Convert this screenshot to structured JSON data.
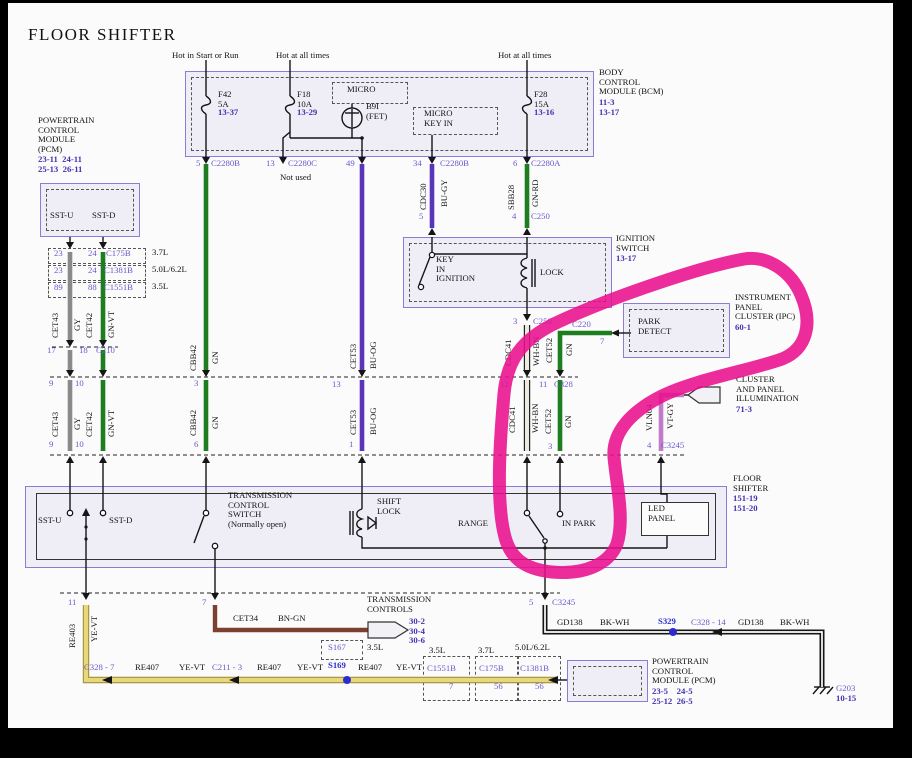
{
  "title": "FLOOR SHIFTER",
  "colors": {
    "module_fill": "#efeef6",
    "module_border": "#8c7cd2",
    "purple_text": "#6b59c9",
    "ref_text": "#4232ae",
    "splice_blue": "#2b2bcf",
    "wire_gray": "#8a8a8a",
    "wire_green": "#1e7d1e",
    "wire_violet": "#5a35b8",
    "wire_white": "#eceade",
    "wire_vtgy": "#c07cc8",
    "wire_yellow": "#e9d87a",
    "wire_yellow_edge": "#a08f3c",
    "wire_brown": "#7b4030",
    "wire_black": "#151515",
    "annotation_pink": "#ea0f8e"
  },
  "annotation": {
    "type": "hand-drawn marker circle",
    "color": "#ea0f8e",
    "encircles": "PARK DETECT (IPC) and RANGE / IN PARK shifter circuit"
  },
  "labels": [
    {
      "n": "page-title",
      "t": "FLOOR SHIFTER",
      "x": 28,
      "y": 30,
      "c": "t"
    },
    {
      "n": "hot-start-run",
      "t": "Hot in Start or Run",
      "x": 172,
      "y": 51
    },
    {
      "n": "hot-all-times-1",
      "t": "Hot at all times",
      "x": 276,
      "y": 51
    },
    {
      "n": "hot-all-times-2",
      "t": "Hot at all times",
      "x": 498,
      "y": 51
    },
    {
      "n": "fuse-f42",
      "t": "F42\n5A",
      "x": 218,
      "y": 90
    },
    {
      "n": "fuse-f42-ref",
      "t": "13-37",
      "x": 218,
      "y": 108,
      "c": "rf"
    },
    {
      "n": "fuse-f18",
      "t": "F18\n10A",
      "x": 297,
      "y": 90
    },
    {
      "n": "fuse-f18-ref",
      "t": "13-29",
      "x": 297,
      "y": 108,
      "c": "rf"
    },
    {
      "n": "fuse-f28",
      "t": "F28\n15A",
      "x": 534,
      "y": 90
    },
    {
      "n": "fuse-f28-ref",
      "t": "13-16",
      "x": 534,
      "y": 108,
      "c": "rf"
    },
    {
      "n": "micro-label",
      "t": "MICRO",
      "x": 347,
      "y": 85
    },
    {
      "n": "b9i-fet-label",
      "t": "B9I\n(FET)",
      "x": 366,
      "y": 102
    },
    {
      "n": "micro-key-in-label",
      "t": "MICRO\nKEY IN",
      "x": 424,
      "y": 109
    },
    {
      "n": "bcm-name",
      "t": "BODY\nCONTROL\nMODULE (BCM)",
      "x": 599,
      "y": 68
    },
    {
      "n": "bcm-refs",
      "t": "11-3\n13-17",
      "x": 599,
      "y": 98,
      "c": "rf"
    },
    {
      "n": "pin-5-c2280b",
      "t": "5",
      "x": 196,
      "y": 159,
      "c": "pp"
    },
    {
      "n": "conn-c2280b-1",
      "t": "C2280B",
      "x": 211,
      "y": 159,
      "c": "pp"
    },
    {
      "n": "pin-13-c2280c",
      "t": "13",
      "x": 266,
      "y": 159,
      "c": "pp"
    },
    {
      "n": "conn-c2280c",
      "t": "C2280C",
      "x": 288,
      "y": 159,
      "c": "pp"
    },
    {
      "n": "not-used",
      "t": "Not used",
      "x": 280,
      "y": 173
    },
    {
      "n": "pin-49",
      "t": "49",
      "x": 346,
      "y": 159,
      "c": "pp"
    },
    {
      "n": "pin-34",
      "t": "34",
      "x": 413,
      "y": 159,
      "c": "pp"
    },
    {
      "n": "conn-c2280b-2",
      "t": "C2280B",
      "x": 440,
      "y": 159,
      "c": "pp"
    },
    {
      "n": "pin-6-c2280a",
      "t": "6",
      "x": 513,
      "y": 159,
      "c": "pp"
    },
    {
      "n": "conn-c2280a",
      "t": "C2280A",
      "x": 531,
      "y": 159,
      "c": "pp"
    },
    {
      "n": "pcm-top-name",
      "t": "POWERTRAIN\nCONTROL\nMODULE\n(PCM)",
      "x": 38,
      "y": 116
    },
    {
      "n": "pcm-top-refs",
      "t": "23-11  24-11\n25-13  26-11",
      "x": 38,
      "y": 155,
      "c": "rf"
    },
    {
      "n": "pcm-sst-u",
      "t": "SST-U",
      "x": 50,
      "y": 211
    },
    {
      "n": "pcm-sst-d",
      "t": "SST-D",
      "x": 92,
      "y": 211
    },
    {
      "n": "pin-a-23",
      "t": "23",
      "x": 54,
      "y": 249,
      "c": "pp"
    },
    {
      "n": "pin-a-24",
      "t": "24",
      "x": 88,
      "y": 249,
      "c": "pp"
    },
    {
      "n": "conn-c175b",
      "t": "C175B",
      "x": 106,
      "y": 249,
      "c": "pp"
    },
    {
      "n": "eng-37l-a",
      "t": "3.7L",
      "x": 152,
      "y": 248
    },
    {
      "n": "pin-b-23",
      "t": "23",
      "x": 54,
      "y": 266,
      "c": "pp"
    },
    {
      "n": "pin-b-24",
      "t": "24",
      "x": 88,
      "y": 266,
      "c": "pp"
    },
    {
      "n": "conn-c1381b-1",
      "t": "C1381B",
      "x": 104,
      "y": 266,
      "c": "pp"
    },
    {
      "n": "eng-50l-a",
      "t": "5.0L/6.2L",
      "x": 152,
      "y": 265
    },
    {
      "n": "pin-c-89",
      "t": "89",
      "x": 54,
      "y": 283,
      "c": "pp"
    },
    {
      "n": "pin-c-88",
      "t": "88",
      "x": 88,
      "y": 283,
      "c": "pp"
    },
    {
      "n": "conn-c1551b-1",
      "t": "C1551B",
      "x": 104,
      "y": 283,
      "c": "pp"
    },
    {
      "n": "eng-35l-a",
      "t": "3.5L",
      "x": 152,
      "y": 282
    },
    {
      "n": "wire-cet43-u",
      "t": "CET43",
      "x": 51,
      "y": 338,
      "c": "vt"
    },
    {
      "n": "wire-gy-u",
      "t": "GY",
      "x": 73,
      "y": 331,
      "c": "vt"
    },
    {
      "n": "wire-cet42-u",
      "t": "CET42",
      "x": 85,
      "y": 338,
      "c": "vt"
    },
    {
      "n": "wire-gnvt-u",
      "t": "GN-VT",
      "x": 107,
      "y": 338,
      "c": "vt"
    },
    {
      "n": "wire-cbb42-u",
      "t": "CBB42",
      "x": 189,
      "y": 371,
      "c": "vt"
    },
    {
      "n": "wire-gn-u1",
      "t": "GN",
      "x": 211,
      "y": 364,
      "c": "vt"
    },
    {
      "n": "wire-cet53-u",
      "t": "CET53",
      "x": 349,
      "y": 369,
      "c": "vt"
    },
    {
      "n": "wire-buog-u",
      "t": "BU-OG",
      "x": 369,
      "y": 369,
      "c": "vt"
    },
    {
      "n": "wire-cdc30",
      "t": "CDC30",
      "x": 419,
      "y": 210,
      "c": "vt"
    },
    {
      "n": "wire-bugy",
      "t": "BU-GY",
      "x": 440,
      "y": 207,
      "c": "vt"
    },
    {
      "n": "wire-sbb28",
      "t": "SBB28",
      "x": 507,
      "y": 210,
      "c": "vt"
    },
    {
      "n": "wire-gnrd",
      "t": "GN-RD",
      "x": 531,
      "y": 207,
      "c": "vt"
    },
    {
      "n": "pin-17",
      "t": "17",
      "x": 47,
      "y": 346,
      "c": "pp"
    },
    {
      "n": "pin-18",
      "t": "18",
      "x": 79,
      "y": 346,
      "c": "pp"
    },
    {
      "n": "conn-c210",
      "t": "C210",
      "x": 96,
      "y": 346,
      "c": "pp"
    },
    {
      "n": "pin-5-c250",
      "t": "5",
      "x": 419,
      "y": 212,
      "c": "pp"
    },
    {
      "n": "pin-4-c250",
      "t": "4",
      "x": 512,
      "y": 212,
      "c": "pp"
    },
    {
      "n": "conn-c250-top",
      "t": "C250",
      "x": 531,
      "y": 212,
      "c": "pp"
    },
    {
      "n": "ign-name",
      "t": "IGNITION\nSWITCH",
      "x": 616,
      "y": 234
    },
    {
      "n": "ign-ref",
      "t": "13-17",
      "x": 616,
      "y": 254,
      "c": "rf"
    },
    {
      "n": "key-in-ignition",
      "t": "KEY\nIN\nIGNITION",
      "x": 436,
      "y": 255
    },
    {
      "n": "lock-label",
      "t": "LOCK",
      "x": 540,
      "y": 268
    },
    {
      "n": "pin-3-c250",
      "t": "3",
      "x": 513,
      "y": 317,
      "c": "pp"
    },
    {
      "n": "conn-c250-bot",
      "t": "C250",
      "x": 533,
      "y": 317,
      "c": "pp"
    },
    {
      "n": "conn-c220",
      "t": "C220",
      "x": 572,
      "y": 320,
      "c": "pp"
    },
    {
      "n": "pin-7-c220",
      "t": "7",
      "x": 600,
      "y": 337,
      "c": "pp"
    },
    {
      "n": "ipc-name",
      "t": "INSTRUMENT\nPANEL\nCLUSTER (IPC)",
      "x": 735,
      "y": 293
    },
    {
      "n": "ipc-ref",
      "t": "60-1",
      "x": 735,
      "y": 323,
      "c": "rf"
    },
    {
      "n": "park-detect",
      "t": "PARK\nDETECT",
      "x": 638,
      "y": 317
    },
    {
      "n": "wire-cdc41-u",
      "t": "CDC41",
      "x": 504,
      "y": 366,
      "c": "vt"
    },
    {
      "n": "wire-whbn-u",
      "t": "WH-BN",
      "x": 532,
      "y": 366,
      "c": "vt"
    },
    {
      "n": "wire-cet52-u",
      "t": "CET52",
      "x": 545,
      "y": 363,
      "c": "vt"
    },
    {
      "n": "wire-gn-u2",
      "t": "GN",
      "x": 565,
      "y": 356,
      "c": "vt"
    },
    {
      "n": "pin-9-c328",
      "t": "9",
      "x": 49,
      "y": 379,
      "c": "pp"
    },
    {
      "n": "pin-10-c328",
      "t": "10",
      "x": 75,
      "y": 379,
      "c": "pp"
    },
    {
      "n": "pin-3-c328",
      "t": "3",
      "x": 194,
      "y": 379,
      "c": "pp"
    },
    {
      "n": "pin-13-c328",
      "t": "13",
      "x": 332,
      "y": 380,
      "c": "pp"
    },
    {
      "n": "pin-12-c328",
      "t": "12",
      "x": 500,
      "y": 380,
      "c": "pp"
    },
    {
      "n": "pin-11-c328",
      "t": "11",
      "x": 539,
      "y": 380,
      "c": "pp"
    },
    {
      "n": "conn-c328",
      "t": "C328",
      "x": 554,
      "y": 380,
      "c": "pp"
    },
    {
      "n": "wire-cet43-l",
      "t": "CET43",
      "x": 51,
      "y": 437,
      "c": "vt"
    },
    {
      "n": "wire-gy-l",
      "t": "GY",
      "x": 73,
      "y": 430,
      "c": "vt"
    },
    {
      "n": "wire-cet42-l",
      "t": "CET42",
      "x": 85,
      "y": 437,
      "c": "vt"
    },
    {
      "n": "wire-gnvt-l",
      "t": "GN-VT",
      "x": 107,
      "y": 437,
      "c": "vt"
    },
    {
      "n": "wire-cbb42-l",
      "t": "CBB42",
      "x": 189,
      "y": 436,
      "c": "vt"
    },
    {
      "n": "wire-gn-l1",
      "t": "GN",
      "x": 211,
      "y": 429,
      "c": "vt"
    },
    {
      "n": "wire-cet53-l",
      "t": "CET53",
      "x": 349,
      "y": 435,
      "c": "vt"
    },
    {
      "n": "wire-buog-l",
      "t": "BU-OG",
      "x": 369,
      "y": 435,
      "c": "vt"
    },
    {
      "n": "wire-cdc41-l",
      "t": "CDC41",
      "x": 508,
      "y": 433,
      "c": "vt"
    },
    {
      "n": "wire-whbn-l",
      "t": "WH-BN",
      "x": 531,
      "y": 433,
      "c": "vt"
    },
    {
      "n": "wire-cet52-l",
      "t": "CET52",
      "x": 544,
      "y": 434,
      "c": "vt"
    },
    {
      "n": "wire-gn-l2",
      "t": "GN",
      "x": 564,
      "y": 428,
      "c": "vt"
    },
    {
      "n": "wire-vln04",
      "t": "VLN04",
      "x": 645,
      "y": 431,
      "c": "vt"
    },
    {
      "n": "wire-vtgy",
      "t": "VT-GY",
      "x": 666,
      "y": 429,
      "c": "vt"
    },
    {
      "n": "illum-name",
      "t": "CLUSTER\nAND PANEL\nILLUMINATION",
      "x": 736,
      "y": 375
    },
    {
      "n": "illum-ref",
      "t": "71-3",
      "x": 736,
      "y": 405,
      "c": "rf"
    },
    {
      "n": "pin-9-c3245",
      "t": "9",
      "x": 49,
      "y": 440,
      "c": "pp"
    },
    {
      "n": "pin-10-c3245",
      "t": "10",
      "x": 75,
      "y": 440,
      "c": "pp"
    },
    {
      "n": "pin-6-c3245",
      "t": "6",
      "x": 194,
      "y": 440,
      "c": "pp"
    },
    {
      "n": "pin-1-c3245",
      "t": "1",
      "x": 349,
      "y": 440,
      "c": "pp"
    },
    {
      "n": "pin-3-c3245",
      "t": "3",
      "x": 548,
      "y": 442,
      "c": "pp"
    },
    {
      "n": "pin-4-c3245",
      "t": "4",
      "x": 647,
      "y": 441,
      "c": "pp"
    },
    {
      "n": "conn-c3245-top",
      "t": "C3245",
      "x": 661,
      "y": 441,
      "c": "pp"
    },
    {
      "n": "fs-name",
      "t": "FLOOR\nSHIFTER",
      "x": 733,
      "y": 474
    },
    {
      "n": "fs-refs",
      "t": "151-19\n151-20",
      "x": 733,
      "y": 494,
      "c": "rf"
    },
    {
      "n": "shifter-sst-u",
      "t": "SST-U",
      "x": 38,
      "y": 516
    },
    {
      "n": "shifter-sst-d",
      "t": "SST-D",
      "x": 109,
      "y": 516
    },
    {
      "n": "tcs-label",
      "t": "TRANSMISSION\nCONTROL\nSWITCH\n(Normally open)",
      "x": 228,
      "y": 491
    },
    {
      "n": "shift-lock-label",
      "t": "SHIFT\nLOCK",
      "x": 377,
      "y": 497
    },
    {
      "n": "range-label",
      "t": "RANGE",
      "x": 458,
      "y": 519
    },
    {
      "n": "in-park-label",
      "t": "IN PARK",
      "x": 562,
      "y": 519
    },
    {
      "n": "led-panel-label",
      "t": "LED\nPANEL",
      "x": 648,
      "y": 504
    },
    {
      "n": "pin-11-bot",
      "t": "11",
      "x": 68,
      "y": 598,
      "c": "pp"
    },
    {
      "n": "pin-7-bot",
      "t": "7",
      "x": 202,
      "y": 598,
      "c": "pp"
    },
    {
      "n": "pin-5-bot",
      "t": "5",
      "x": 529,
      "y": 598,
      "c": "pp"
    },
    {
      "n": "conn-c3245-bot",
      "t": "C3245",
      "x": 552,
      "y": 598,
      "c": "pp"
    },
    {
      "n": "wire-re403",
      "t": "RE403",
      "x": 68,
      "y": 648,
      "c": "vt"
    },
    {
      "n": "wire-yevt-0",
      "t": "YE-VT",
      "x": 90,
      "y": 642,
      "c": "vt"
    },
    {
      "n": "wire-cet34",
      "t": "CET34",
      "x": 233,
      "y": 614
    },
    {
      "n": "wire-bngn",
      "t": "BN-GN",
      "x": 278,
      "y": 614
    },
    {
      "n": "tc-name",
      "t": "TRANSMISSION\nCONTROLS",
      "x": 367,
      "y": 595
    },
    {
      "n": "tc-refs",
      "t": "30-2\n30-4\n30-6",
      "x": 409,
      "y": 617,
      "c": "rf"
    },
    {
      "n": "conn-c328-7",
      "t": "C328 - 7",
      "x": 84,
      "y": 663,
      "c": "pp"
    },
    {
      "n": "wire-re407-1",
      "t": "RE407",
      "x": 135,
      "y": 663
    },
    {
      "n": "wire-yevt-1",
      "t": "YE-VT",
      "x": 179,
      "y": 663
    },
    {
      "n": "conn-c211-3",
      "t": "C211 - 3",
      "x": 212,
      "y": 663,
      "c": "pp"
    },
    {
      "n": "wire-re407-2",
      "t": "RE407",
      "x": 257,
      "y": 663
    },
    {
      "n": "wire-yevt-2",
      "t": "YE-VT",
      "x": 297,
      "y": 663
    },
    {
      "n": "splice-s167",
      "t": "S167",
      "x": 328,
      "y": 643,
      "c": "pp"
    },
    {
      "n": "eng-35l-s167",
      "t": "3.5L",
      "x": 367,
      "y": 643
    },
    {
      "n": "splice-s169",
      "t": "S169",
      "x": 328,
      "y": 661,
      "c": "bl"
    },
    {
      "n": "wire-re407-3",
      "t": "RE407",
      "x": 358,
      "y": 663
    },
    {
      "n": "wire-yevt-3",
      "t": "YE-VT",
      "x": 396,
      "y": 663
    },
    {
      "n": "eng-35l-b",
      "t": "3.5L",
      "x": 429,
      "y": 646
    },
    {
      "n": "conn-c1551b-2",
      "t": "C1551B",
      "x": 427,
      "y": 664,
      "c": "pp"
    },
    {
      "n": "pin-7-c1551b",
      "t": "7",
      "x": 449,
      "y": 682,
      "c": "pp"
    },
    {
      "n": "eng-37l-b",
      "t": "3.7L",
      "x": 478,
      "y": 646
    },
    {
      "n": "conn-c175b-2",
      "t": "C175B",
      "x": 479,
      "y": 664,
      "c": "pp"
    },
    {
      "n": "pin-56-c175b",
      "t": "56",
      "x": 494,
      "y": 682,
      "c": "pp"
    },
    {
      "n": "eng-50l-b",
      "t": "5.0L/6.2L",
      "x": 515,
      "y": 643
    },
    {
      "n": "conn-c1381b-2",
      "t": "C1381B",
      "x": 520,
      "y": 664,
      "c": "pp"
    },
    {
      "n": "pin-56-c1381b",
      "t": "56",
      "x": 535,
      "y": 682,
      "c": "pp"
    },
    {
      "n": "pcm-bot-name",
      "t": "POWERTRAIN\nCONTROL\nMODULE (PCM)",
      "x": 652,
      "y": 657
    },
    {
      "n": "pcm-bot-refs",
      "t": "23-5    24-5\n25-12  26-5",
      "x": 652,
      "y": 687,
      "c": "rf"
    },
    {
      "n": "wire-gd138-1",
      "t": "GD138",
      "x": 557,
      "y": 618
    },
    {
      "n": "wire-bkwh-1",
      "t": "BK-WH",
      "x": 600,
      "y": 618
    },
    {
      "n": "splice-s329",
      "t": "S329",
      "x": 658,
      "y": 617,
      "c": "bl"
    },
    {
      "n": "conn-c328-14",
      "t": "C328 - 14",
      "x": 691,
      "y": 618,
      "c": "pp"
    },
    {
      "n": "wire-gd138-2",
      "t": "GD138",
      "x": 738,
      "y": 618
    },
    {
      "n": "wire-bkwh-2",
      "t": "BK-WH",
      "x": 780,
      "y": 618
    },
    {
      "n": "ground-g203",
      "t": "G203",
      "x": 836,
      "y": 684,
      "c": "pp"
    },
    {
      "n": "ground-g203-ref",
      "t": "10-15",
      "x": 836,
      "y": 694,
      "c": "rf"
    }
  ]
}
